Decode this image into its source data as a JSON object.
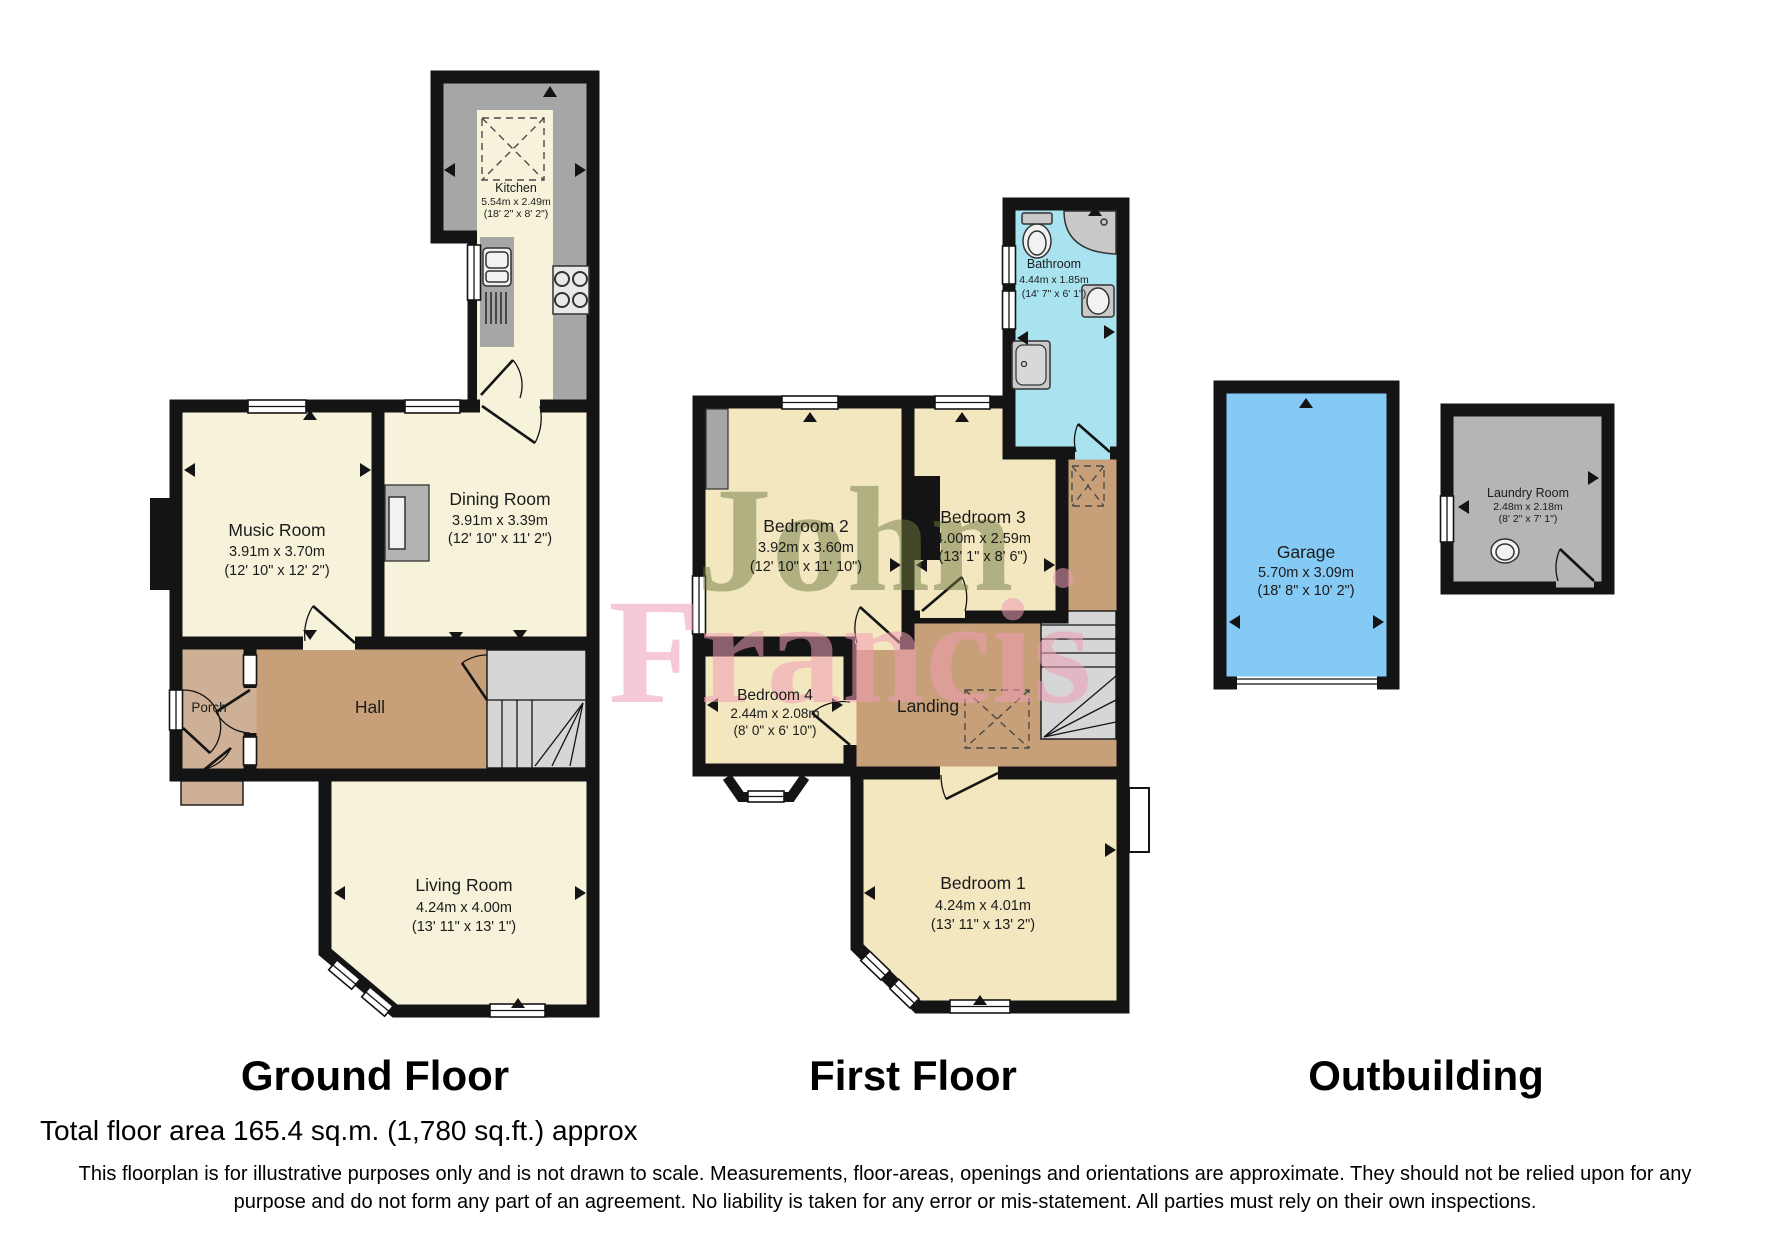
{
  "document_type": "floorplan",
  "watermark": {
    "line1": "John",
    "line2": "Francis"
  },
  "sections": {
    "ground": "Ground Floor",
    "first": "First Floor",
    "outbuilding": "Outbuilding"
  },
  "rooms": {
    "kitchen": {
      "name": "Kitchen",
      "metric": "5.54m x 2.49m",
      "imperial": "(18' 2\" x 8' 2\")"
    },
    "music_room": {
      "name": "Music Room",
      "metric": "3.91m x 3.70m",
      "imperial": "(12' 10\" x 12' 2\")"
    },
    "dining_room": {
      "name": "Dining Room",
      "metric": "3.91m x 3.39m",
      "imperial": "(12' 10\" x 11' 2\")"
    },
    "porch": {
      "name": "Porch"
    },
    "hall": {
      "name": "Hall"
    },
    "living_room": {
      "name": "Living Room",
      "metric": "4.24m x 4.00m",
      "imperial": "(13' 11\" x 13' 1\")"
    },
    "bathroom": {
      "name": "Bathroom",
      "metric": "4.44m x 1.85m",
      "imperial": "(14' 7\" x 6' 1\")"
    },
    "bedroom2": {
      "name": "Bedroom 2",
      "metric": "3.92m x 3.60m",
      "imperial": "(12' 10\" x 11' 10\")"
    },
    "bedroom3": {
      "name": "Bedroom 3",
      "metric": "4.00m x 2.59m",
      "imperial": "(13' 1\" x 8' 6\")"
    },
    "bedroom4": {
      "name": "Bedroom 4",
      "metric": "2.44m x 2.08m",
      "imperial": "(8' 0\" x 6' 10\")"
    },
    "landing": {
      "name": "Landing"
    },
    "bedroom1": {
      "name": "Bedroom 1",
      "metric": "4.24m x 4.01m",
      "imperial": "(13' 11\" x 13' 2\")"
    },
    "garage": {
      "name": "Garage",
      "metric": "5.70m x 3.09m",
      "imperial": "(18' 8\" x 10' 2\")"
    },
    "laundry_room": {
      "name": "Laundry Room",
      "metric": "2.48m x 2.18m",
      "imperial": "(8' 2\" x 7' 1\")"
    }
  },
  "footer": {
    "total_area": "Total floor area 165.4 sq.m. (1,780 sq.ft.) approx",
    "disclaimer_line1": "This floorplan is for illustrative purposes only and is not drawn to scale. Measurements, floor-areas, openings and orientations are approximate. They should not be relied upon for any",
    "disclaimer_line2": "purpose and do not form any part of an agreement. No liability is taken for any error or mis-statement. All parties must rely on their own inspections."
  },
  "colors": {
    "wall": "#141414",
    "room_cream": "#f7f2da",
    "room_yellow": "#f3e7c0",
    "hall_tan": "#c7a07a",
    "porch_tan": "#cdb096",
    "bathroom_blue": "#a9e3f0",
    "garage_blue": "#85c9f5",
    "laundry_grey": "#b5b5b5",
    "counter_grey": "#a6a6a6",
    "stairs_grey": "#d6d6d6",
    "watermark_olive": "#6f7a40",
    "watermark_pink": "#ef9db4"
  }
}
